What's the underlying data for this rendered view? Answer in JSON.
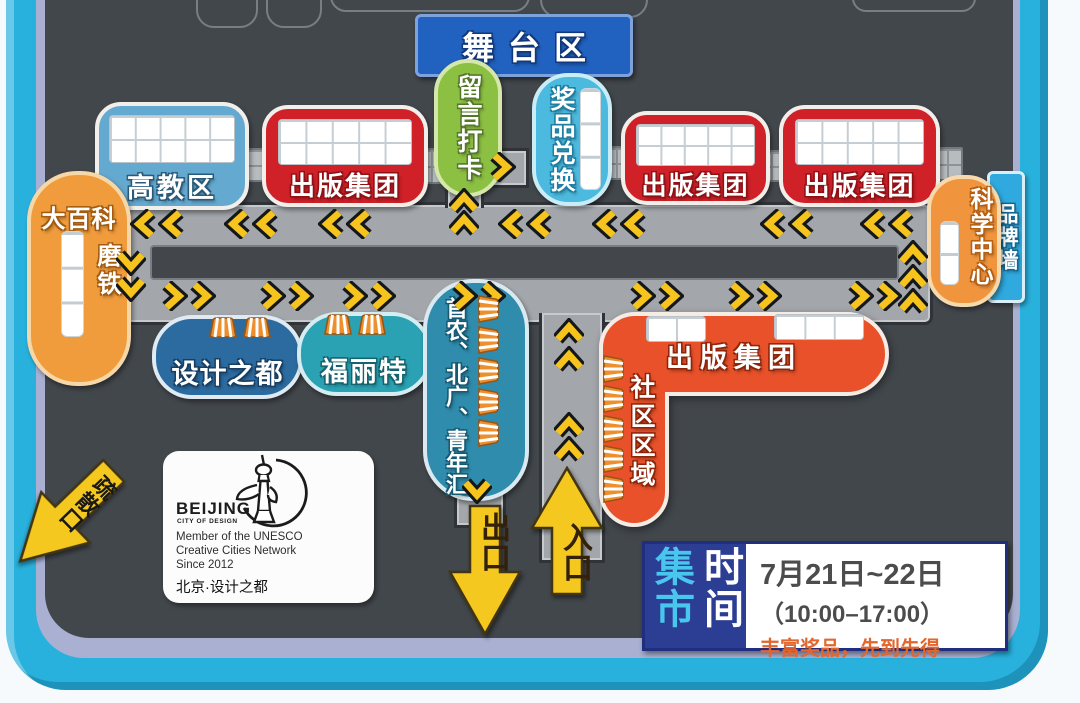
{
  "stage": {
    "label": "舞台区"
  },
  "booths": {
    "higher_ed": {
      "label": "高教区"
    },
    "publishing_1": {
      "label": "出版集团"
    },
    "message_checkin": {
      "label": "留言打卡"
    },
    "prize_exchange": {
      "label": "奖品兑换"
    },
    "publishing_2": {
      "label": "出版集团"
    },
    "publishing_3": {
      "label": "出版集团"
    },
    "science_center": {
      "label": "科学中心"
    },
    "brand_wall": {
      "label": "品牌墙"
    },
    "encyclopedia": {
      "label": "大百科",
      "label2": "磨铁"
    },
    "design_capital": {
      "label": "设计之都"
    },
    "fulite": {
      "label": "福丽特"
    },
    "shounong": {
      "label": "首农、北广、青年汇"
    },
    "community_publishing": {
      "label": "出版集团"
    },
    "community_zone": {
      "label": "社区区域"
    }
  },
  "arrows": {
    "exit": "出口",
    "entrance": "入口",
    "evacuation": "疏散口"
  },
  "logo_card": {
    "brand": "BEIJING",
    "brand_sub": "CITY OF DESIGN",
    "member_line1": "Member of the UNESCO",
    "member_line2": "Creative Cities Network",
    "member_line3": "Since 2012",
    "cn_name": "北京·设计之都"
  },
  "schedule": {
    "label_market": "集市",
    "label_time": "时间",
    "date_range": "7月21日~22日",
    "hours": "（10:00–17:00）",
    "note": "丰富奖品，先到先得"
  },
  "colors": {
    "frame_cyan": "#29b1dd",
    "map_background": "#42474c",
    "path_gray": "#a3a7ab",
    "chevron_yellow": "#f6c41d",
    "booth_red": "#d02028",
    "booth_blue": "#64a9cf",
    "oval_green": "#8cc043",
    "oval_cyan": "#4cbade",
    "oval_orange": "#f0953e",
    "community_orange": "#e8512a",
    "arrow_yellow": "#f4c81e",
    "schedule_navy": "#2c3e94"
  },
  "map_decor": {
    "chevrons": [
      {
        "x": 130,
        "y": 209,
        "d": "left"
      },
      {
        "x": 158,
        "y": 209,
        "d": "left"
      },
      {
        "x": 224,
        "y": 209,
        "d": "left"
      },
      {
        "x": 252,
        "y": 209,
        "d": "left"
      },
      {
        "x": 318,
        "y": 209,
        "d": "left"
      },
      {
        "x": 346,
        "y": 209,
        "d": "left"
      },
      {
        "x": 498,
        "y": 209,
        "d": "left"
      },
      {
        "x": 526,
        "y": 209,
        "d": "left"
      },
      {
        "x": 592,
        "y": 209,
        "d": "left"
      },
      {
        "x": 620,
        "y": 209,
        "d": "left"
      },
      {
        "x": 760,
        "y": 209,
        "d": "left"
      },
      {
        "x": 788,
        "y": 209,
        "d": "left"
      },
      {
        "x": 860,
        "y": 209,
        "d": "left"
      },
      {
        "x": 888,
        "y": 209,
        "d": "left"
      },
      {
        "x": 158,
        "y": 281,
        "d": "right"
      },
      {
        "x": 186,
        "y": 281,
        "d": "right"
      },
      {
        "x": 256,
        "y": 281,
        "d": "right"
      },
      {
        "x": 284,
        "y": 281,
        "d": "right"
      },
      {
        "x": 338,
        "y": 281,
        "d": "right"
      },
      {
        "x": 366,
        "y": 281,
        "d": "right"
      },
      {
        "x": 448,
        "y": 281,
        "d": "right"
      },
      {
        "x": 476,
        "y": 281,
        "d": "right"
      },
      {
        "x": 626,
        "y": 281,
        "d": "right"
      },
      {
        "x": 654,
        "y": 281,
        "d": "right"
      },
      {
        "x": 724,
        "y": 281,
        "d": "right"
      },
      {
        "x": 752,
        "y": 281,
        "d": "right"
      },
      {
        "x": 844,
        "y": 281,
        "d": "right"
      },
      {
        "x": 872,
        "y": 281,
        "d": "right"
      },
      {
        "x": 116,
        "y": 246,
        "d": "down"
      },
      {
        "x": 116,
        "y": 272,
        "d": "down"
      },
      {
        "x": 898,
        "y": 240,
        "d": "up"
      },
      {
        "x": 898,
        "y": 264,
        "d": "up"
      },
      {
        "x": 898,
        "y": 288,
        "d": "up"
      },
      {
        "x": 449,
        "y": 188,
        "d": "up"
      },
      {
        "x": 449,
        "y": 210,
        "d": "up"
      },
      {
        "x": 486,
        "y": 152,
        "d": "right"
      },
      {
        "x": 554,
        "y": 318,
        "d": "up"
      },
      {
        "x": 554,
        "y": 346,
        "d": "up"
      },
      {
        "x": 554,
        "y": 412,
        "d": "up"
      },
      {
        "x": 554,
        "y": 436,
        "d": "up"
      },
      {
        "x": 462,
        "y": 474,
        "d": "down"
      }
    ],
    "awnings": [
      {
        "x": 208,
        "y": 316,
        "r": 0
      },
      {
        "x": 242,
        "y": 316,
        "r": 0
      },
      {
        "x": 323,
        "y": 313,
        "r": 0
      },
      {
        "x": 357,
        "y": 313,
        "r": 0
      },
      {
        "x": 472,
        "y": 296,
        "r": 90
      },
      {
        "x": 472,
        "y": 327,
        "r": 90
      },
      {
        "x": 472,
        "y": 358,
        "r": 90
      },
      {
        "x": 472,
        "y": 389,
        "r": 90
      },
      {
        "x": 472,
        "y": 420,
        "r": 90
      },
      {
        "x": 597,
        "y": 356,
        "r": 90
      },
      {
        "x": 597,
        "y": 386,
        "r": 90
      },
      {
        "x": 597,
        "y": 416,
        "r": 90
      },
      {
        "x": 597,
        "y": 446,
        "r": 90
      },
      {
        "x": 597,
        "y": 476,
        "r": 90
      }
    ]
  }
}
